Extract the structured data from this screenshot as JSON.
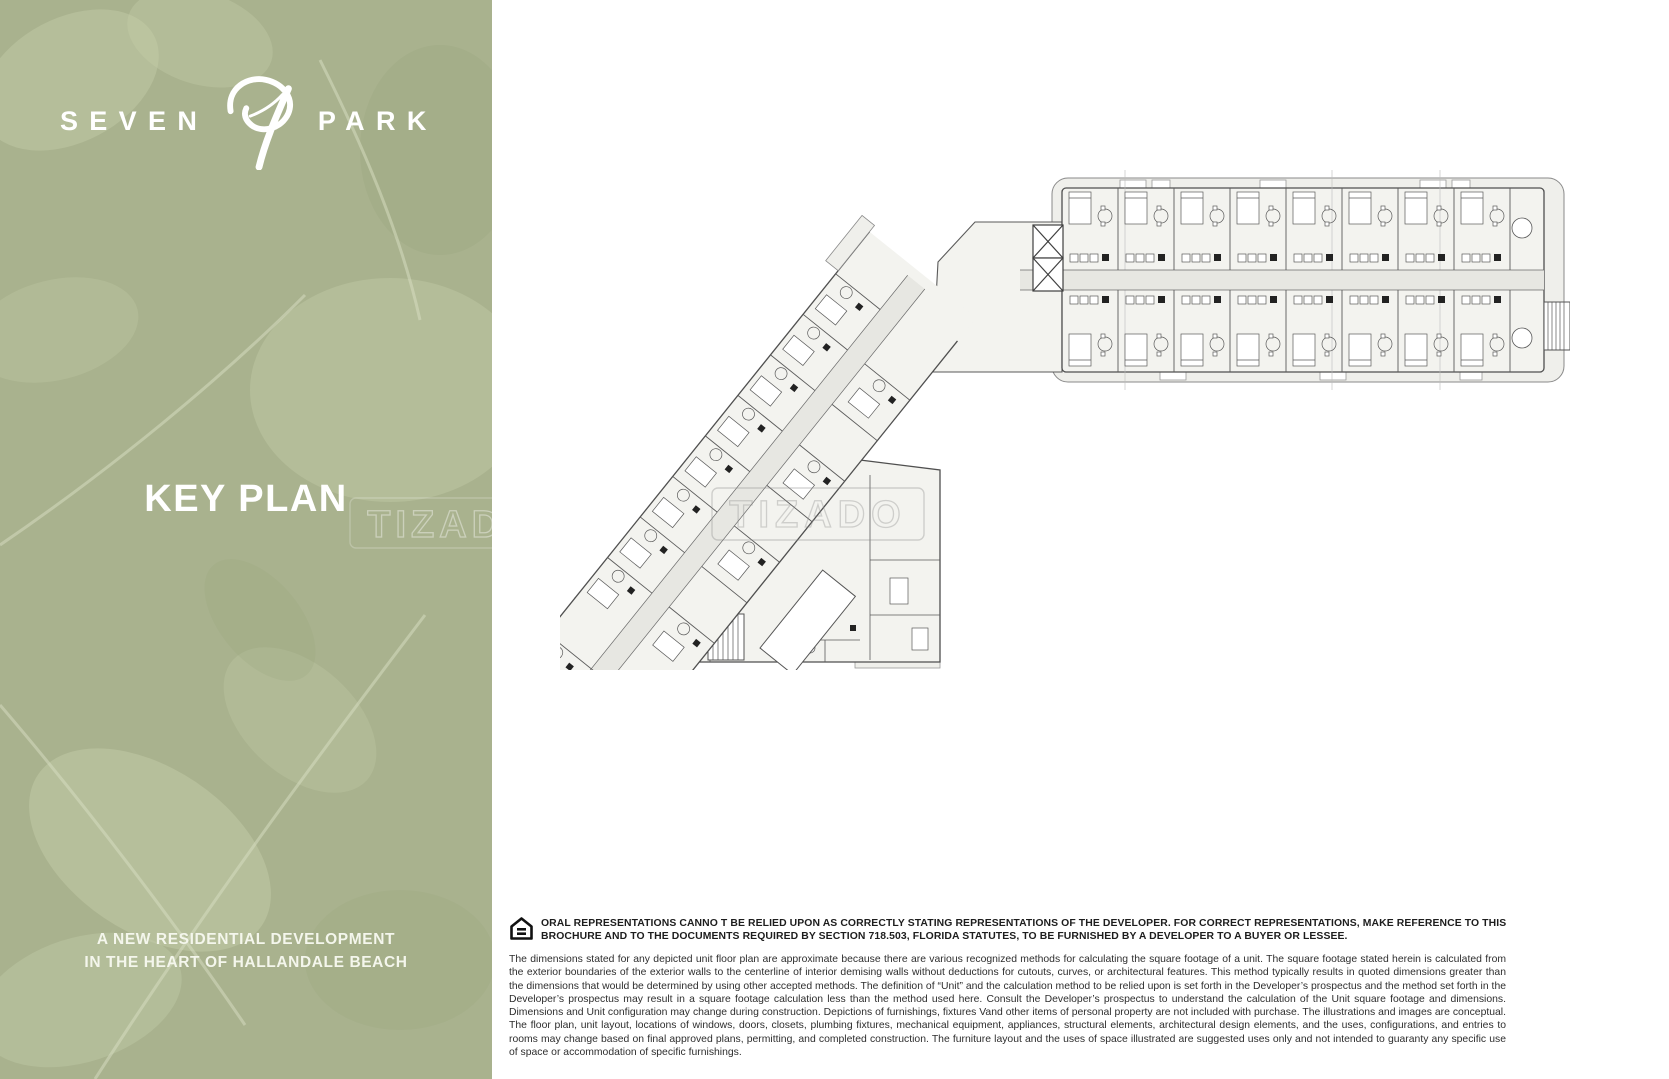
{
  "brand": {
    "name_left": "SEVEN",
    "name_right": "PARK",
    "logo_icon": "leaf-seven-monogram"
  },
  "left_panel": {
    "title": "KEY PLAN",
    "tagline_line1": "A NEW RESIDENTIAL DEVELOPMENT",
    "tagline_line2": "IN THE HEART OF HALLANDALE BEACH",
    "bg_color": "#a9b28e",
    "leaf_highlight_color": "#c6cdad",
    "text_color": "#ffffff"
  },
  "watermark": {
    "text": "TIZADO"
  },
  "plan": {
    "name": "key-plan-floorplan",
    "line_color": "#4f4f4f",
    "fill_color": "#f3f3ef",
    "corridor_color": "#e7e7e2"
  },
  "legal": {
    "housing_icon": "equal-housing-opportunity-icon",
    "notice_bold": "ORAL REPRESENTATIONS CANNO T BE RELIED UPON AS CORRECTLY STATING REPRESENTATIONS OF THE DEVELOPER. FOR CORRECT REPRESENTATIONS, MAKE REFERENCE TO THIS BROCHURE AND TO THE DOCUMENTS REQUIRED BY SECTION 718.503, FLORIDA STATUTES, TO BE FURNISHED BY A DEVELOPER TO A BUYER OR LESSEE.",
    "disclaimer": "The dimensions stated for any depicted unit floor plan are approximate because there are various recognized methods for calculating the square footage of a unit. The square footage stated herein is calculated from the exterior boundaries of the exterior walls to the centerline of interior demising walls without deductions for cutouts, curves, or architectural features. This method typically results in quoted dimensions greater than the dimensions that would be determined by using other accepted methods. The definition of “Unit” and the calculation method to be relied upon is set forth in the Developer’s prospectus and the method set forth in the Developer’s prospectus may result in a square footage calculation less than the method used here. Consult the Developer’s prospectus to understand the calculation of the Unit square footage and dimensions. Dimensions and Unit configuration may change during construction. Depictions of furnishings, fixtures Vand other items of personal property are not included with purchase. The illustrations and images are conceptual. The floor plan, unit layout, locations of windows, doors, closets, plumbing fixtures, mechanical equipment, appliances, structural elements, architectural design elements, and the uses, configurations, and entries to rooms may change based on final approved plans, permitting, and completed construction. The furniture layout and the uses of space illustrated are suggested uses only and not intended to guaranty any specific use of space or accommodation of specific furnishings."
  }
}
